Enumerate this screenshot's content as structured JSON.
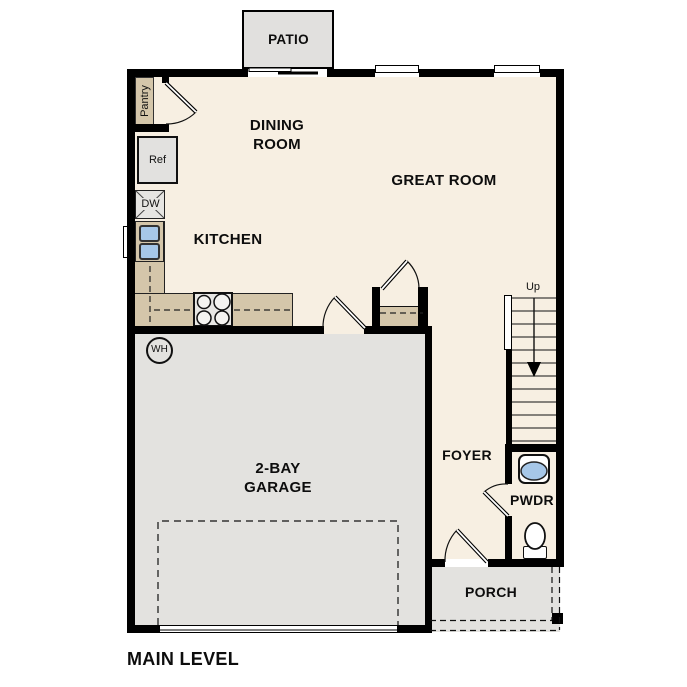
{
  "title": "MAIN LEVEL",
  "rooms": {
    "patio": {
      "label": "PATIO"
    },
    "dining_room": {
      "label_line1": "DINING",
      "label_line2": "ROOM"
    },
    "great_room": {
      "label": "GREAT ROOM"
    },
    "kitchen": {
      "label": "KITCHEN"
    },
    "garage": {
      "label_line1": "2-BAY",
      "label_line2": "GARAGE"
    },
    "foyer": {
      "label": "FOYER"
    },
    "powder_room": {
      "label": "PWDR"
    },
    "porch": {
      "label": "PORCH"
    }
  },
  "fixtures": {
    "pantry": {
      "label": "Pantry"
    },
    "refrigerator": {
      "label": "Ref"
    },
    "dishwasher": {
      "label": "DW"
    },
    "water_heater": {
      "label": "WH"
    },
    "stairs": {
      "direction_label": "Up"
    }
  },
  "colors": {
    "floor": "#f7efe2",
    "hard_surface": "#e3e2df",
    "counter": "#d4c6aa",
    "sink_basin": "#a6c7e8",
    "wall": "#000000",
    "background": "#ffffff",
    "text": "#111111"
  }
}
